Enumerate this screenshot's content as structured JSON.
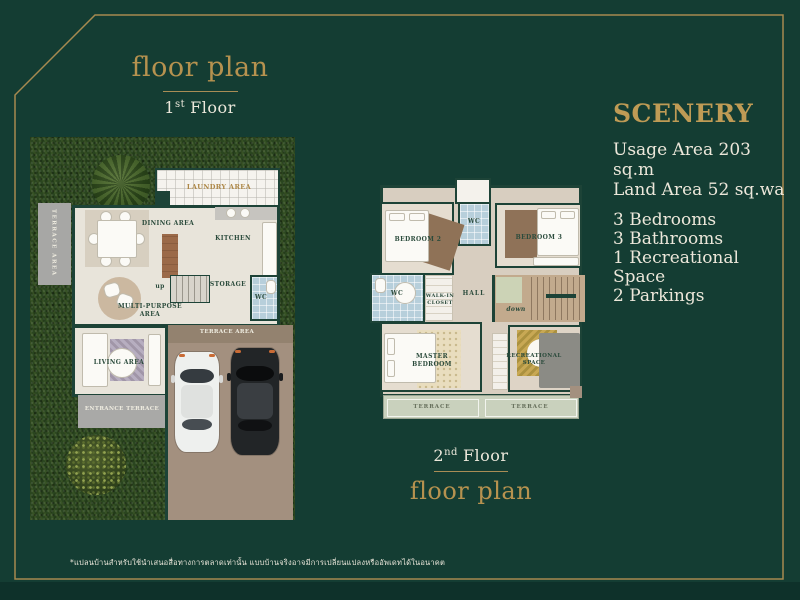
{
  "titles": {
    "first": {
      "heading": "floor plan",
      "floor_num": "1",
      "floor_ord": "st",
      "floor_word": "Floor"
    },
    "second": {
      "heading": "floor plan",
      "floor_num": "2",
      "floor_ord": "nd",
      "floor_word": "Floor"
    }
  },
  "info": {
    "title": "SCENERY",
    "area_lines": [
      "Usage Area 203 sq.m",
      "Land Area 52 sq.wa"
    ],
    "feature_lines": [
      "3 Bedrooms",
      "3 Bathrooms",
      "1 Recreational Space",
      "2 Parkings"
    ]
  },
  "floor1": {
    "terrace_side": "TERRACE AREA",
    "laundry": "LAUNDRY AREA",
    "dining": "DINING AREA",
    "kitchen": "KITCHEN",
    "storage": "STORAGE",
    "wc": "WC",
    "stairs": "up",
    "multipurpose": "MULTI-PURPOSE AREA",
    "living": "LIVING AREA",
    "entrance": "ENTRANCE TERRACE",
    "driveway": "TERRACE AREA"
  },
  "floor2": {
    "bedroom2": "BEDROOM 2",
    "bedroom3": "BEDROOM 3",
    "wc_top": "WC",
    "wc_left": "WC",
    "walkin": "WALK-IN CLOSET",
    "hall": "HALL",
    "stairs": "down",
    "master": "MASTER BEDROOM",
    "recreation": "RECREATIONAL SPACE",
    "terrace_left": "TERRACE",
    "terrace_right": "TERRACE"
  },
  "footer": {
    "disclaimer": "*แปลนบ้านสำหรับใช้นำเสนอสื่อทางการตลาดเท่านั้น แบบบ้านจริงอาจมีการเปลี่ยนแปลงหรืออัพเดทได้ในอนาคต"
  },
  "colors": {
    "background": "#143d33",
    "gold": "#b6924f",
    "text_light": "#ece7da"
  }
}
